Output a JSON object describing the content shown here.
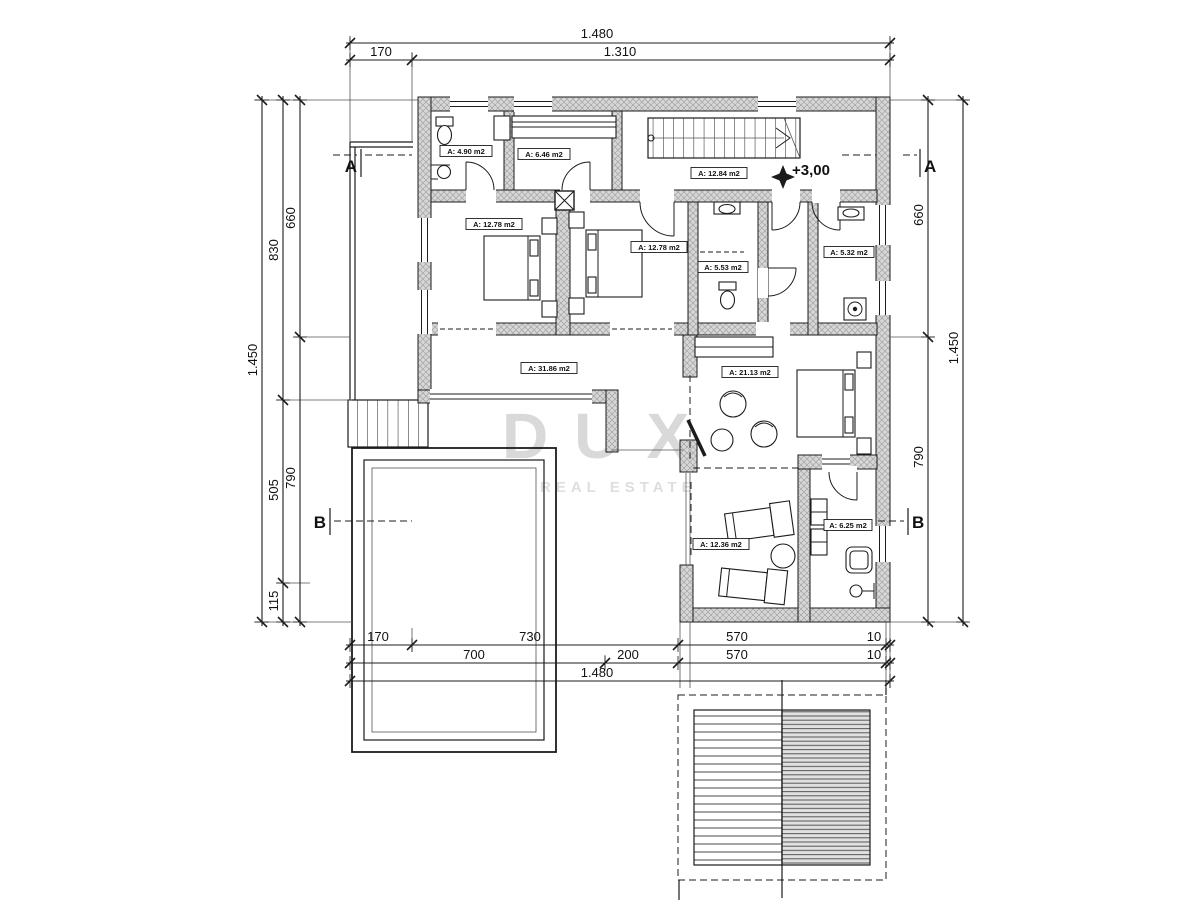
{
  "drawing": {
    "title": "floor-plan",
    "watermark": {
      "brand": "DUX",
      "tagline": "REAL ESTATE"
    },
    "elevation": {
      "label": "+3,00"
    },
    "sections": {
      "a": "A",
      "b": "B"
    },
    "dims": {
      "top_total": "1.480",
      "top_seg_left": "170",
      "top_seg_right": "1.310",
      "left_total": "1.450",
      "left_upper": "660",
      "left_lower": "790",
      "left_mid_upper": "830",
      "left_mid_lower": "505",
      "left_mid_bottom": "115",
      "right_total": "1.450",
      "right_upper": "660",
      "right_lower": "790",
      "bottom_row1": [
        "170",
        "730",
        "570",
        "10"
      ],
      "bottom_row2": [
        "700",
        "200",
        "570",
        "10"
      ],
      "bottom_total": "1.480"
    },
    "rooms": [
      {
        "id": "bathroom-nw",
        "label": "A: 4.90 m2"
      },
      {
        "id": "closet",
        "label": "A: 6.46 m2"
      },
      {
        "id": "hall-stairs",
        "label": "A: 12.84 m2"
      },
      {
        "id": "bedroom-1",
        "label": "A: 12.78 m2"
      },
      {
        "id": "bedroom-2",
        "label": "A: 12.78 m2"
      },
      {
        "id": "bathroom-mid",
        "label": "A: 5.53 m2"
      },
      {
        "id": "bathroom-e",
        "label": "A: 5.32 m2"
      },
      {
        "id": "living-hall",
        "label": "A: 31.86 m2"
      },
      {
        "id": "bedroom-3",
        "label": "A: 21.13 m2"
      },
      {
        "id": "sunroom",
        "label": "A: 12.36 m2"
      },
      {
        "id": "bathroom-s",
        "label": "A: 6.25 m2"
      }
    ],
    "colors": {
      "line": "#1c1c1c",
      "wall_fill": "#d7d7d7",
      "hatch_line": "#a3a3a3",
      "watermark": "#d9d9d9",
      "watermark_small": "#dedede",
      "background": "#ffffff"
    }
  }
}
